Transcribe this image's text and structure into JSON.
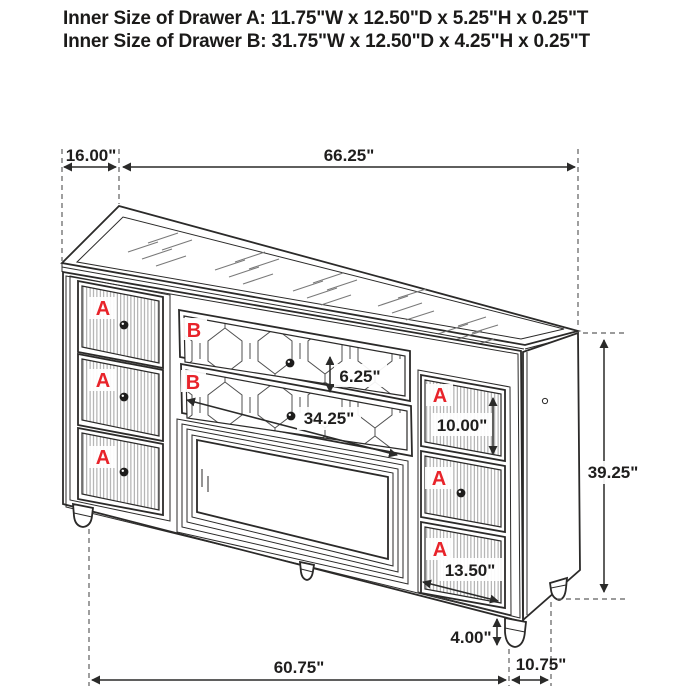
{
  "title": {
    "line1": "Inner Size of Drawer A: 11.75\"W x 12.50\"D x 5.25\"H x 0.25\"T",
    "line2": "Inner Size of Drawer B: 31.75\"W x 12.50\"D x 4.25\"H x 0.25\"T"
  },
  "drawer_labels": {
    "a": "A",
    "b": "B"
  },
  "dimensions": {
    "top_depth": "16.00\"",
    "top_width": "66.25\"",
    "drawer_b_height": "6.25\"",
    "drawer_b_width": "34.25\"",
    "drawer_a_height": "10.00\"",
    "overall_height": "39.25\"",
    "bottom_drawer_height": "13.50\"",
    "leg_height": "4.00\"",
    "base_width": "60.75\"",
    "base_depth": "10.75\""
  },
  "colors": {
    "accent_red": "#e8232a",
    "line_dark": "#2b2a29",
    "dimension_text": "#1f1e1d",
    "background": "#ffffff"
  }
}
